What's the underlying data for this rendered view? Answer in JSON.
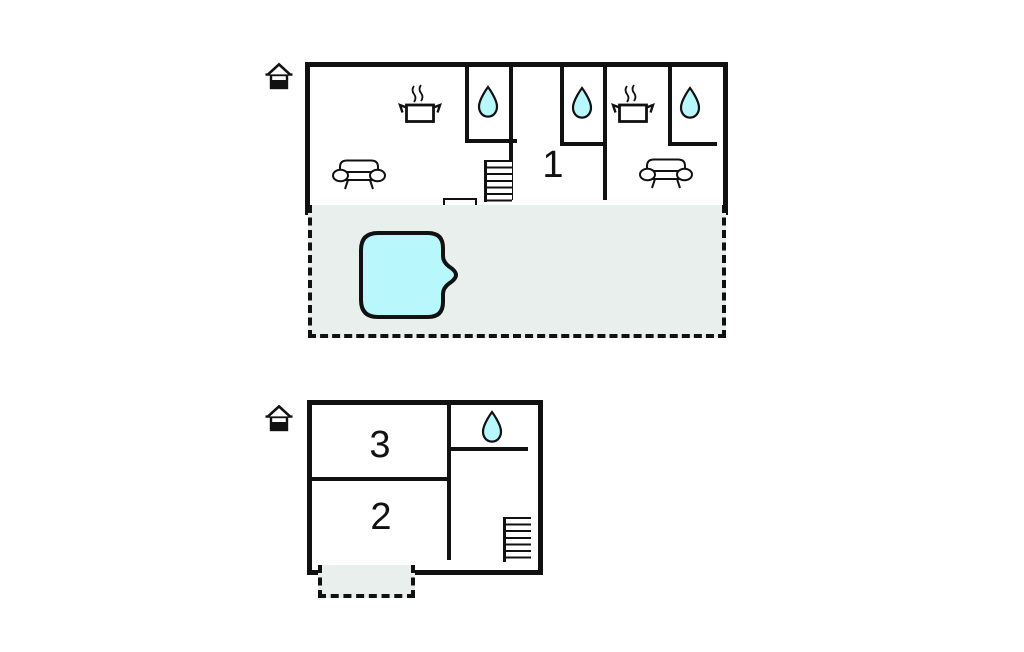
{
  "colors": {
    "wall": "#111111",
    "water_fill": "#b8f7fb",
    "outdoor_fill": "#e9efec",
    "background": "#ffffff"
  },
  "upper_floor": {
    "name": "upper-floor-plan",
    "room_label": "1",
    "icons": {
      "level": "house-icon",
      "stoves": [
        "stove-pot-icon",
        "stove-pot-icon"
      ],
      "drops": [
        "water-drop-icon",
        "water-drop-icon",
        "water-drop-icon"
      ],
      "sofas": [
        "sofa-icon",
        "sofa-icon"
      ],
      "stairs": "stairs",
      "door": "entrance-door"
    },
    "outdoor_area": {
      "feature": "swimming-pool"
    }
  },
  "lower_floor": {
    "name": "lower-floor-plan",
    "room_labels": {
      "top": "3",
      "bottom": "2"
    },
    "icons": {
      "level": "house-icon",
      "drop": "water-drop-icon",
      "stairs": "stairs"
    },
    "outdoor_area": {
      "feature": "terrace"
    }
  }
}
